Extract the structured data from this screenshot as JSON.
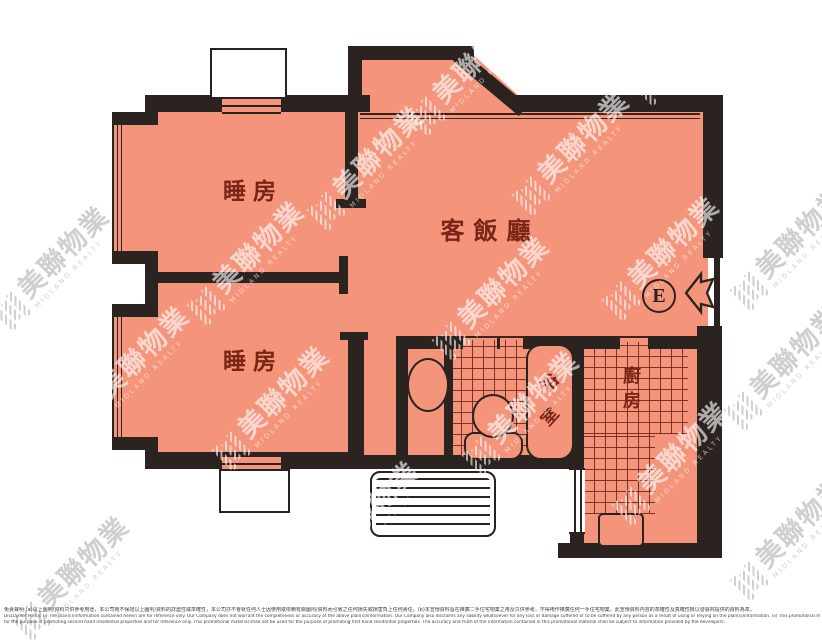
{
  "floor_plan": {
    "rooms": {
      "bedroom1": "睡房",
      "bedroom2": "睡房",
      "living_dining": "客飯廳",
      "bathroom": "浴室",
      "kitchen": "廚房"
    },
    "entrance_label": "E",
    "colors": {
      "room_fill": "#F3947B",
      "wall": "#2B2320",
      "grid_line": "#601A0E",
      "label_text": "#7A2416"
    }
  },
  "watermark": {
    "zh": "美聯物業",
    "en": "MIDLAND REALTY"
  },
  "disclaimer": {
    "zh": "免責聲明:(a)以上圖則/資料只供參考用途，本公司概不保證以上圖則/資料的詳盡性或準確性，本公司亦不會就任何人士因使用或依賴有關圖則/資料而引致之任何損失或損害負上任何責任。(b)本宣傳資料旨在推廣二手住宅物業之用及只供參考，不得用作推廣任何一手住宅物業，此宣傳資料內容的準確性及真確性概以發展商提供的資料為準。",
    "en1": "Disclaimer Policy: (i) The plan(s)/information contained herein are for reference only. Our Company does not warrant the completeness or accuracy of the above plan(s)/information. Our Company also disclaims any liability whatsoever for any loss or damage suffered or to be suffered by any person as a result of using or relying on the plan(s)/information. (ii) This promotional material is",
    "en2": "for the purpose of promoting second hand residential properties and for reference only. This promotional material shall not be used for the purpose of promoting first hand residential properties. The accuracy and truth of the information contained in this promotional material shall be subject to information provided by the developers."
  }
}
